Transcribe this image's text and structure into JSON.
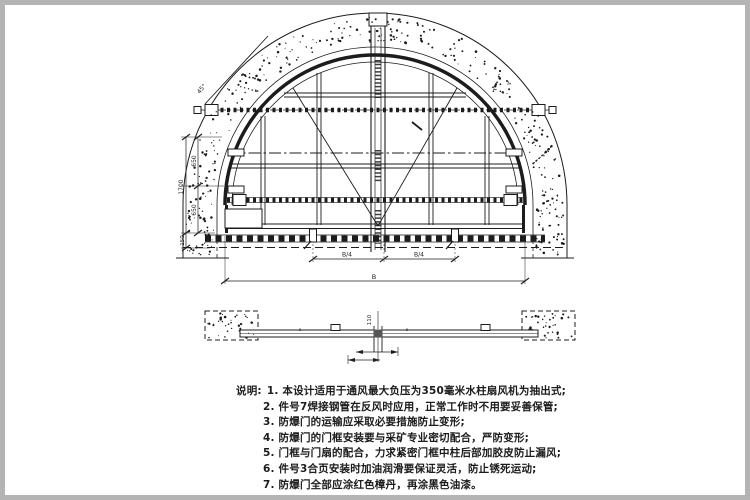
{
  "colors": {
    "ink": "#1c1c1c",
    "paper": "#ffffff",
    "frame_border": "#b4b4b4"
  },
  "drawing": {
    "views": {
      "elevation": "front elevation of arched blast door",
      "plan": "plan section of door"
    },
    "dims": {
      "total_height": "1700",
      "seg_upper": "650",
      "seg_lower": "650",
      "base": "150",
      "angle": "45°",
      "quarter_left": "B/4",
      "quarter_right": "B/4",
      "total_width": "B",
      "plan_center": "110"
    }
  },
  "notes": {
    "label": "说明:",
    "items": [
      "1. 本设计适用于通风最大负压为350毫米水柱扇风机为抽出式;",
      "2. 件号7焊接钢管在反风时应用，正常工作时不用要妥善保管;",
      "3. 防爆门的运输应采取必要措施防止变形;",
      "4. 防爆门的门框安装要与采矿专业密切配合，严防变形;",
      "5. 门框与门扇的配合，力求紧密门框中柱后部加胶皮防止漏风;",
      "6. 件号3合页安装时加油润滑要保证灵活，防止锈死运动;",
      "7. 防爆门全部应涂红色樟丹，再涂黑色油漆。"
    ]
  }
}
